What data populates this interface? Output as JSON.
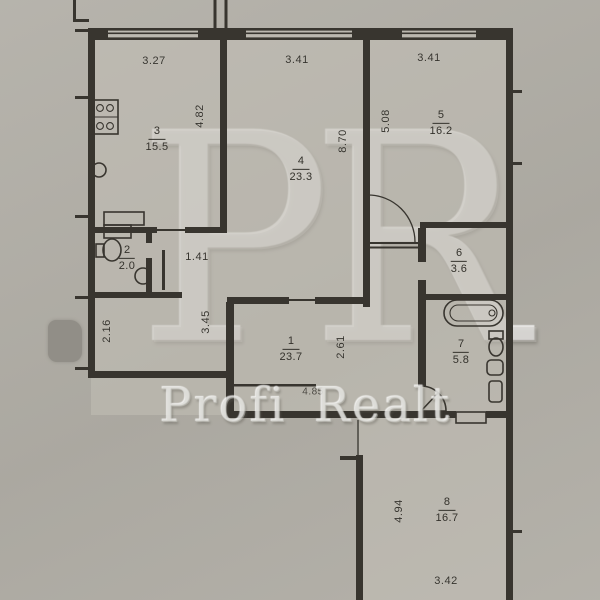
{
  "watermark": {
    "logo": "PR",
    "brand": "Profi Realt"
  },
  "rooms": [
    {
      "id": "1",
      "area": "23.7"
    },
    {
      "id": "2",
      "area": "2.0"
    },
    {
      "id": "3",
      "area": "15.5"
    },
    {
      "id": "4",
      "area": "23.3"
    },
    {
      "id": "5",
      "area": "16.2"
    },
    {
      "id": "6",
      "area": "3.6"
    },
    {
      "id": "7",
      "area": "5.8"
    },
    {
      "id": "8",
      "area": "16.7"
    }
  ],
  "dimensions": {
    "room3_width": "3.27",
    "room4_width": "3.41",
    "room5_width": "3.41",
    "room3_depth": "4.82",
    "room4_depth": "8.70",
    "room5_depth": "5.08",
    "hall_niche": "1.41",
    "nook_depth": "2.16",
    "nook_height": "3.45",
    "hall_depth": "2.61",
    "hall_width": "4.85",
    "room8_depth": "4.94",
    "room8_width": "3.42"
  },
  "fixtures": [
    "stove",
    "kitchen-sink",
    "counter",
    "wc-toilet",
    "wc-sink",
    "bathtub",
    "toilet",
    "wash-sink",
    "door-swing"
  ],
  "colors": {
    "paper": "#b2afa7",
    "paper_light": "#c4c1b9",
    "ink": "#38352f",
    "watermark": "#cfcdc7"
  }
}
